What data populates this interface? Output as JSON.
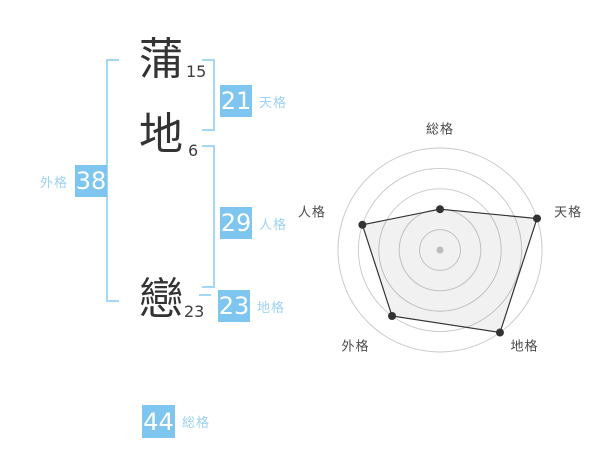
{
  "name": {
    "characters": [
      {
        "char": "蒲",
        "strokes": "15"
      },
      {
        "char": "地",
        "strokes": "6"
      },
      {
        "char": "戀",
        "strokes": "23"
      }
    ]
  },
  "grids": {
    "tenkaku": {
      "label": "天格",
      "value": "21"
    },
    "jinkaku": {
      "label": "人格",
      "value": "29"
    },
    "chikaku": {
      "label": "地格",
      "value": "23"
    },
    "gaikaku": {
      "label": "外格",
      "value": "38"
    },
    "soukaku": {
      "label": "総格",
      "value": "44"
    }
  },
  "colors": {
    "accent_blue": "#7ec5f0",
    "light_blue": "#9cd2f4",
    "bracket_blue": "#a4d7f5",
    "text_dark": "#333333",
    "radar_grid": "#cccccc",
    "radar_stroke": "#333333",
    "radar_fill": "rgba(0,0,0,0.055)",
    "vertex_dot": "#333333",
    "center_dot": "#bbbbbb",
    "axis_label": "#4a4a4a"
  },
  "chart_data": {
    "type": "radar",
    "axes": [
      "総格",
      "天格",
      "地格",
      "外格",
      "人格"
    ],
    "values": [
      40,
      100,
      100,
      80,
      80
    ],
    "max": 100,
    "rings": 5,
    "start_angle_deg": 0,
    "direction": "clockwise",
    "grid": true,
    "legend": false,
    "title": ""
  }
}
